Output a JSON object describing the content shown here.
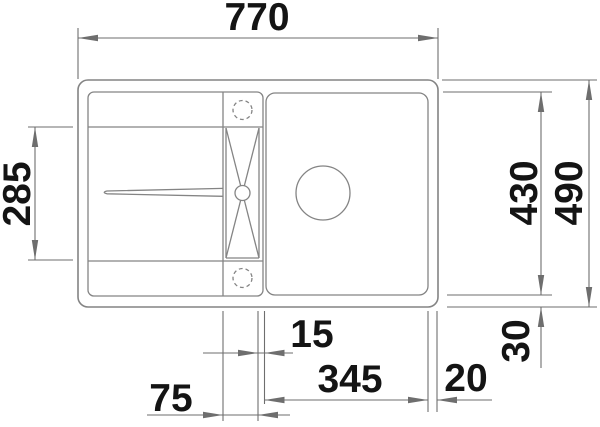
{
  "drawing": {
    "type": "technical-dimension-drawing",
    "subject": "kitchen sink with drainboard, top view",
    "units": "mm",
    "colors": {
      "outline": "#848484",
      "dimension_line": "#6e6e6e",
      "text": "#141414",
      "background": "#ffffff"
    },
    "dims": {
      "width_total": "770",
      "drainboard_depth": "285",
      "height_inner": "430",
      "height_total": "490",
      "bottom_margin": "30",
      "mid_gap": "15",
      "bowl_width": "345",
      "right_margin": "20",
      "channel_offset": "75"
    }
  }
}
